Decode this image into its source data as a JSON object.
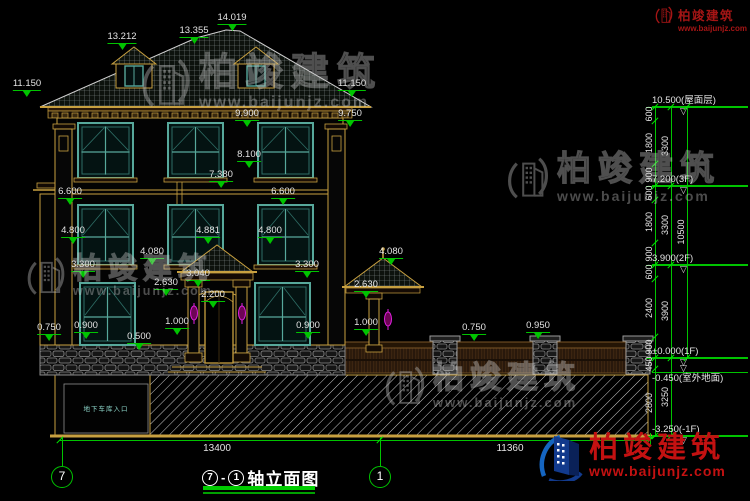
{
  "colors": {
    "background": "#000000",
    "dim_line": "#00c400",
    "dim_text": "#e4e4e4",
    "trim": "#c8a040",
    "window_frame": "#57a89b",
    "lamp": "#e020e0",
    "brand_red": "#c31111",
    "brand_blue": "#123a8c",
    "watermark_gray": "#b9b9b9"
  },
  "watermark": {
    "brand": "柏竣建筑",
    "url": "www.baijunjz.com"
  },
  "header_logo": {
    "brand": "柏竣建筑",
    "url": "www.baijunjz.com"
  },
  "footer_logo": {
    "brand": "柏竣建筑",
    "url": "www.baijunjz.com"
  },
  "drawing": {
    "title": {
      "axis_from": "7",
      "separator": "-",
      "axis_to": "1",
      "text": "轴立面图"
    },
    "axis_bubbles": [
      {
        "label": "7"
      },
      {
        "label": "1"
      }
    ],
    "bottom_dims": [
      {
        "value": "13400"
      },
      {
        "value": "11360"
      }
    ],
    "basement_label": "地下车库入口",
    "elevation_labels": [
      {
        "t": "14.019",
        "x": 232,
        "y": 12
      },
      {
        "t": "13.355",
        "x": 194,
        "y": 25
      },
      {
        "t": "13.212",
        "x": 122,
        "y": 31
      },
      {
        "t": "11.150",
        "x": 27,
        "y": 78
      },
      {
        "t": "11.150",
        "x": 352,
        "y": 78
      },
      {
        "t": "9.900",
        "x": 247,
        "y": 108
      },
      {
        "t": "9.750",
        "x": 350,
        "y": 108
      },
      {
        "t": "8.100",
        "x": 249,
        "y": 149
      },
      {
        "t": "7.380",
        "x": 221,
        "y": 169
      },
      {
        "t": "6.600",
        "x": 70,
        "y": 186
      },
      {
        "t": "6.600",
        "x": 283,
        "y": 186
      },
      {
        "t": "4.800",
        "x": 73,
        "y": 225
      },
      {
        "t": "4.881",
        "x": 208,
        "y": 225
      },
      {
        "t": "4.800",
        "x": 270,
        "y": 225
      },
      {
        "t": "4.080",
        "x": 152,
        "y": 246
      },
      {
        "t": "4.080",
        "x": 391,
        "y": 246
      },
      {
        "t": "3.300",
        "x": 83,
        "y": 259
      },
      {
        "t": "3.300",
        "x": 307,
        "y": 259
      },
      {
        "t": "3.040",
        "x": 198,
        "y": 268
      },
      {
        "t": "2.630",
        "x": 166,
        "y": 277
      },
      {
        "t": "2.630",
        "x": 366,
        "y": 279
      },
      {
        "t": "2.200",
        "x": 213,
        "y": 289
      },
      {
        "t": "1.000",
        "x": 177,
        "y": 316
      },
      {
        "t": "1.000",
        "x": 366,
        "y": 317
      },
      {
        "t": "0.900",
        "x": 86,
        "y": 320
      },
      {
        "t": "0.900",
        "x": 308,
        "y": 320
      },
      {
        "t": "0.750",
        "x": 49,
        "y": 322
      },
      {
        "t": "0.500",
        "x": 139,
        "y": 331
      },
      {
        "t": "0.750",
        "x": 474,
        "y": 322
      },
      {
        "t": "0.950",
        "x": 538,
        "y": 320
      }
    ],
    "right_levels": [
      {
        "t": "10.500(屋面层)",
        "y": 107,
        "below": false
      },
      {
        "t": "7.200(3F)",
        "y": 186,
        "below": false
      },
      {
        "t": "3.900(2F)",
        "y": 265,
        "below": false
      },
      {
        "t": "±0.000(1F)",
        "y": 358,
        "below": false
      },
      {
        "t": "-0.450(室外地面)",
        "y": 372,
        "below": true
      },
      {
        "t": "-3.250(-1F)",
        "y": 436,
        "below": false
      }
    ],
    "chain_labels": [
      {
        "t": "600",
        "x": 649,
        "y": 114
      },
      {
        "t": "1800",
        "x": 649,
        "y": 143
      },
      {
        "t": "900",
        "x": 649,
        "y": 175
      },
      {
        "t": "600",
        "x": 649,
        "y": 193
      },
      {
        "t": "1800",
        "x": 649,
        "y": 222
      },
      {
        "t": "900",
        "x": 649,
        "y": 254
      },
      {
        "t": "600",
        "x": 649,
        "y": 272
      },
      {
        "t": "2400",
        "x": 649,
        "y": 308
      },
      {
        "t": "900",
        "x": 649,
        "y": 347
      },
      {
        "t": "450",
        "x": 649,
        "y": 364
      },
      {
        "t": "2800",
        "x": 649,
        "y": 403
      },
      {
        "t": "3300",
        "x": 665,
        "y": 146
      },
      {
        "t": "3300",
        "x": 665,
        "y": 225
      },
      {
        "t": "3900",
        "x": 665,
        "y": 311
      },
      {
        "t": "3250",
        "x": 665,
        "y": 397
      },
      {
        "t": "10500",
        "x": 681,
        "y": 232
      }
    ],
    "green_lines": [
      {
        "x": 655,
        "y": 107,
        "w": 1,
        "h": 329
      },
      {
        "x": 671,
        "y": 107,
        "w": 1,
        "h": 329
      },
      {
        "x": 687,
        "y": 107,
        "w": 1,
        "h": 251
      },
      {
        "x": 646,
        "y": 107,
        "w": 102,
        "h": 1
      },
      {
        "x": 646,
        "y": 186,
        "w": 102,
        "h": 1
      },
      {
        "x": 646,
        "y": 265,
        "w": 102,
        "h": 1
      },
      {
        "x": 646,
        "y": 358,
        "w": 102,
        "h": 1
      },
      {
        "x": 655,
        "y": 372,
        "w": 93,
        "h": 1
      },
      {
        "x": 646,
        "y": 436,
        "w": 102,
        "h": 1
      },
      {
        "x": 60,
        "y": 440,
        "w": 590,
        "h": 1
      },
      {
        "x": 62,
        "y": 437,
        "w": 1,
        "h": 29
      },
      {
        "x": 380,
        "y": 437,
        "w": 1,
        "h": 29
      },
      {
        "x": 650,
        "y": 433,
        "w": 1,
        "h": 12
      }
    ],
    "tick_marks": [
      {
        "x": 655,
        "ys": [
          107,
          121,
          164,
          186,
          200,
          243,
          265,
          279,
          337,
          358,
          369,
          436
        ]
      },
      {
        "x": 671,
        "ys": [
          107,
          186,
          265,
          358,
          436
        ]
      },
      {
        "x": 687,
        "ys": [
          107,
          358
        ]
      },
      {
        "x": 60,
        "ys": [
          440
        ]
      },
      {
        "x": 380,
        "ys": [
          440
        ]
      },
      {
        "x": 650,
        "ys": [
          440
        ]
      }
    ]
  }
}
